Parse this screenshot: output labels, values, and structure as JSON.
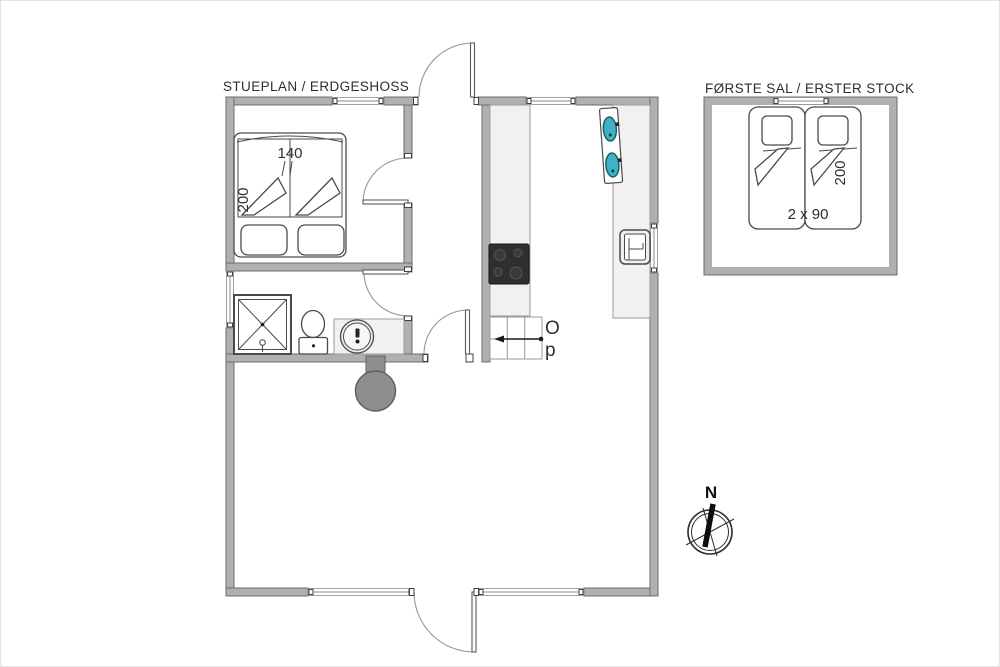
{
  "titles": {
    "ground_floor": "STUEPLAN / ERDGESHOSS",
    "first_floor": "FØRSTE SAL / ERSTER STOCK"
  },
  "ground_floor": {
    "bed": {
      "width_label": "140",
      "length_label": "200"
    },
    "stairs": {
      "up_line1": "O",
      "up_line2": "p"
    }
  },
  "first_floor": {
    "bed": {
      "size_label": "2 x 90",
      "length_label": "200"
    }
  },
  "compass": {
    "north": "N"
  },
  "fixtures": [
    "double-bed",
    "single-bed",
    "footstool",
    "shower",
    "toilet",
    "washbasin",
    "wood-stove",
    "cooktop",
    "kitchen-sink",
    "dishwasher",
    "staircase",
    "compass-rose"
  ],
  "colors": {
    "wall_fill": "#b0b0b0",
    "wall_stroke": "#6b6b6b",
    "counter_fill": "#f1f1f1",
    "cooktop_fill": "#2f2f2f",
    "sink_basin_fill": "#41b1c4",
    "sink_basin_stroke": "#19606e",
    "stove_fill": "#8e8e8e",
    "fixture_stroke": "#4a4a4a",
    "text_color": "#2d2d2d",
    "background": "#ffffff"
  }
}
